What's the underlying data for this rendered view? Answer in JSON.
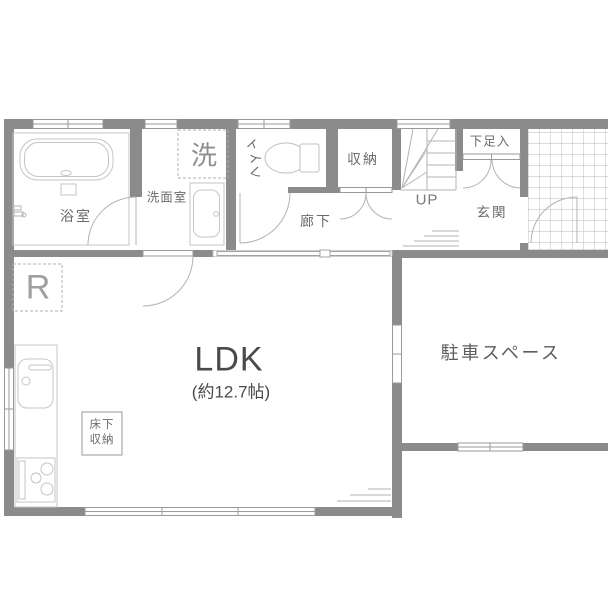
{
  "floor_plan": {
    "labels": {
      "bathroom": "浴室",
      "washing_machine": "洗",
      "washroom": "洗面室",
      "toilet_chars": [
        "ト",
        "イ",
        "レ"
      ],
      "storage": "収納",
      "hallway": "廊下",
      "stairs_direction": "UP",
      "shoe_cabinet": "下足入",
      "entrance": "玄関",
      "refrigerator": "R",
      "underfloor_storage_lines": [
        "床下",
        "収納"
      ],
      "living_dining_kitchen": "LDK",
      "living_size": "(約12.7帖)",
      "parking": "駐車スペース"
    },
    "colors": {
      "wall": "#8b8b8b",
      "fixture_line": "#c5c5c5",
      "door_line": "#b3b3b3",
      "window_line": "#9a9a9a",
      "grid_line": "#b8b8b8",
      "label_text": "#6b6b6b",
      "dark_text": "#4a4a4a",
      "light_text": "#a0a0a0",
      "background": "#ffffff"
    }
  }
}
